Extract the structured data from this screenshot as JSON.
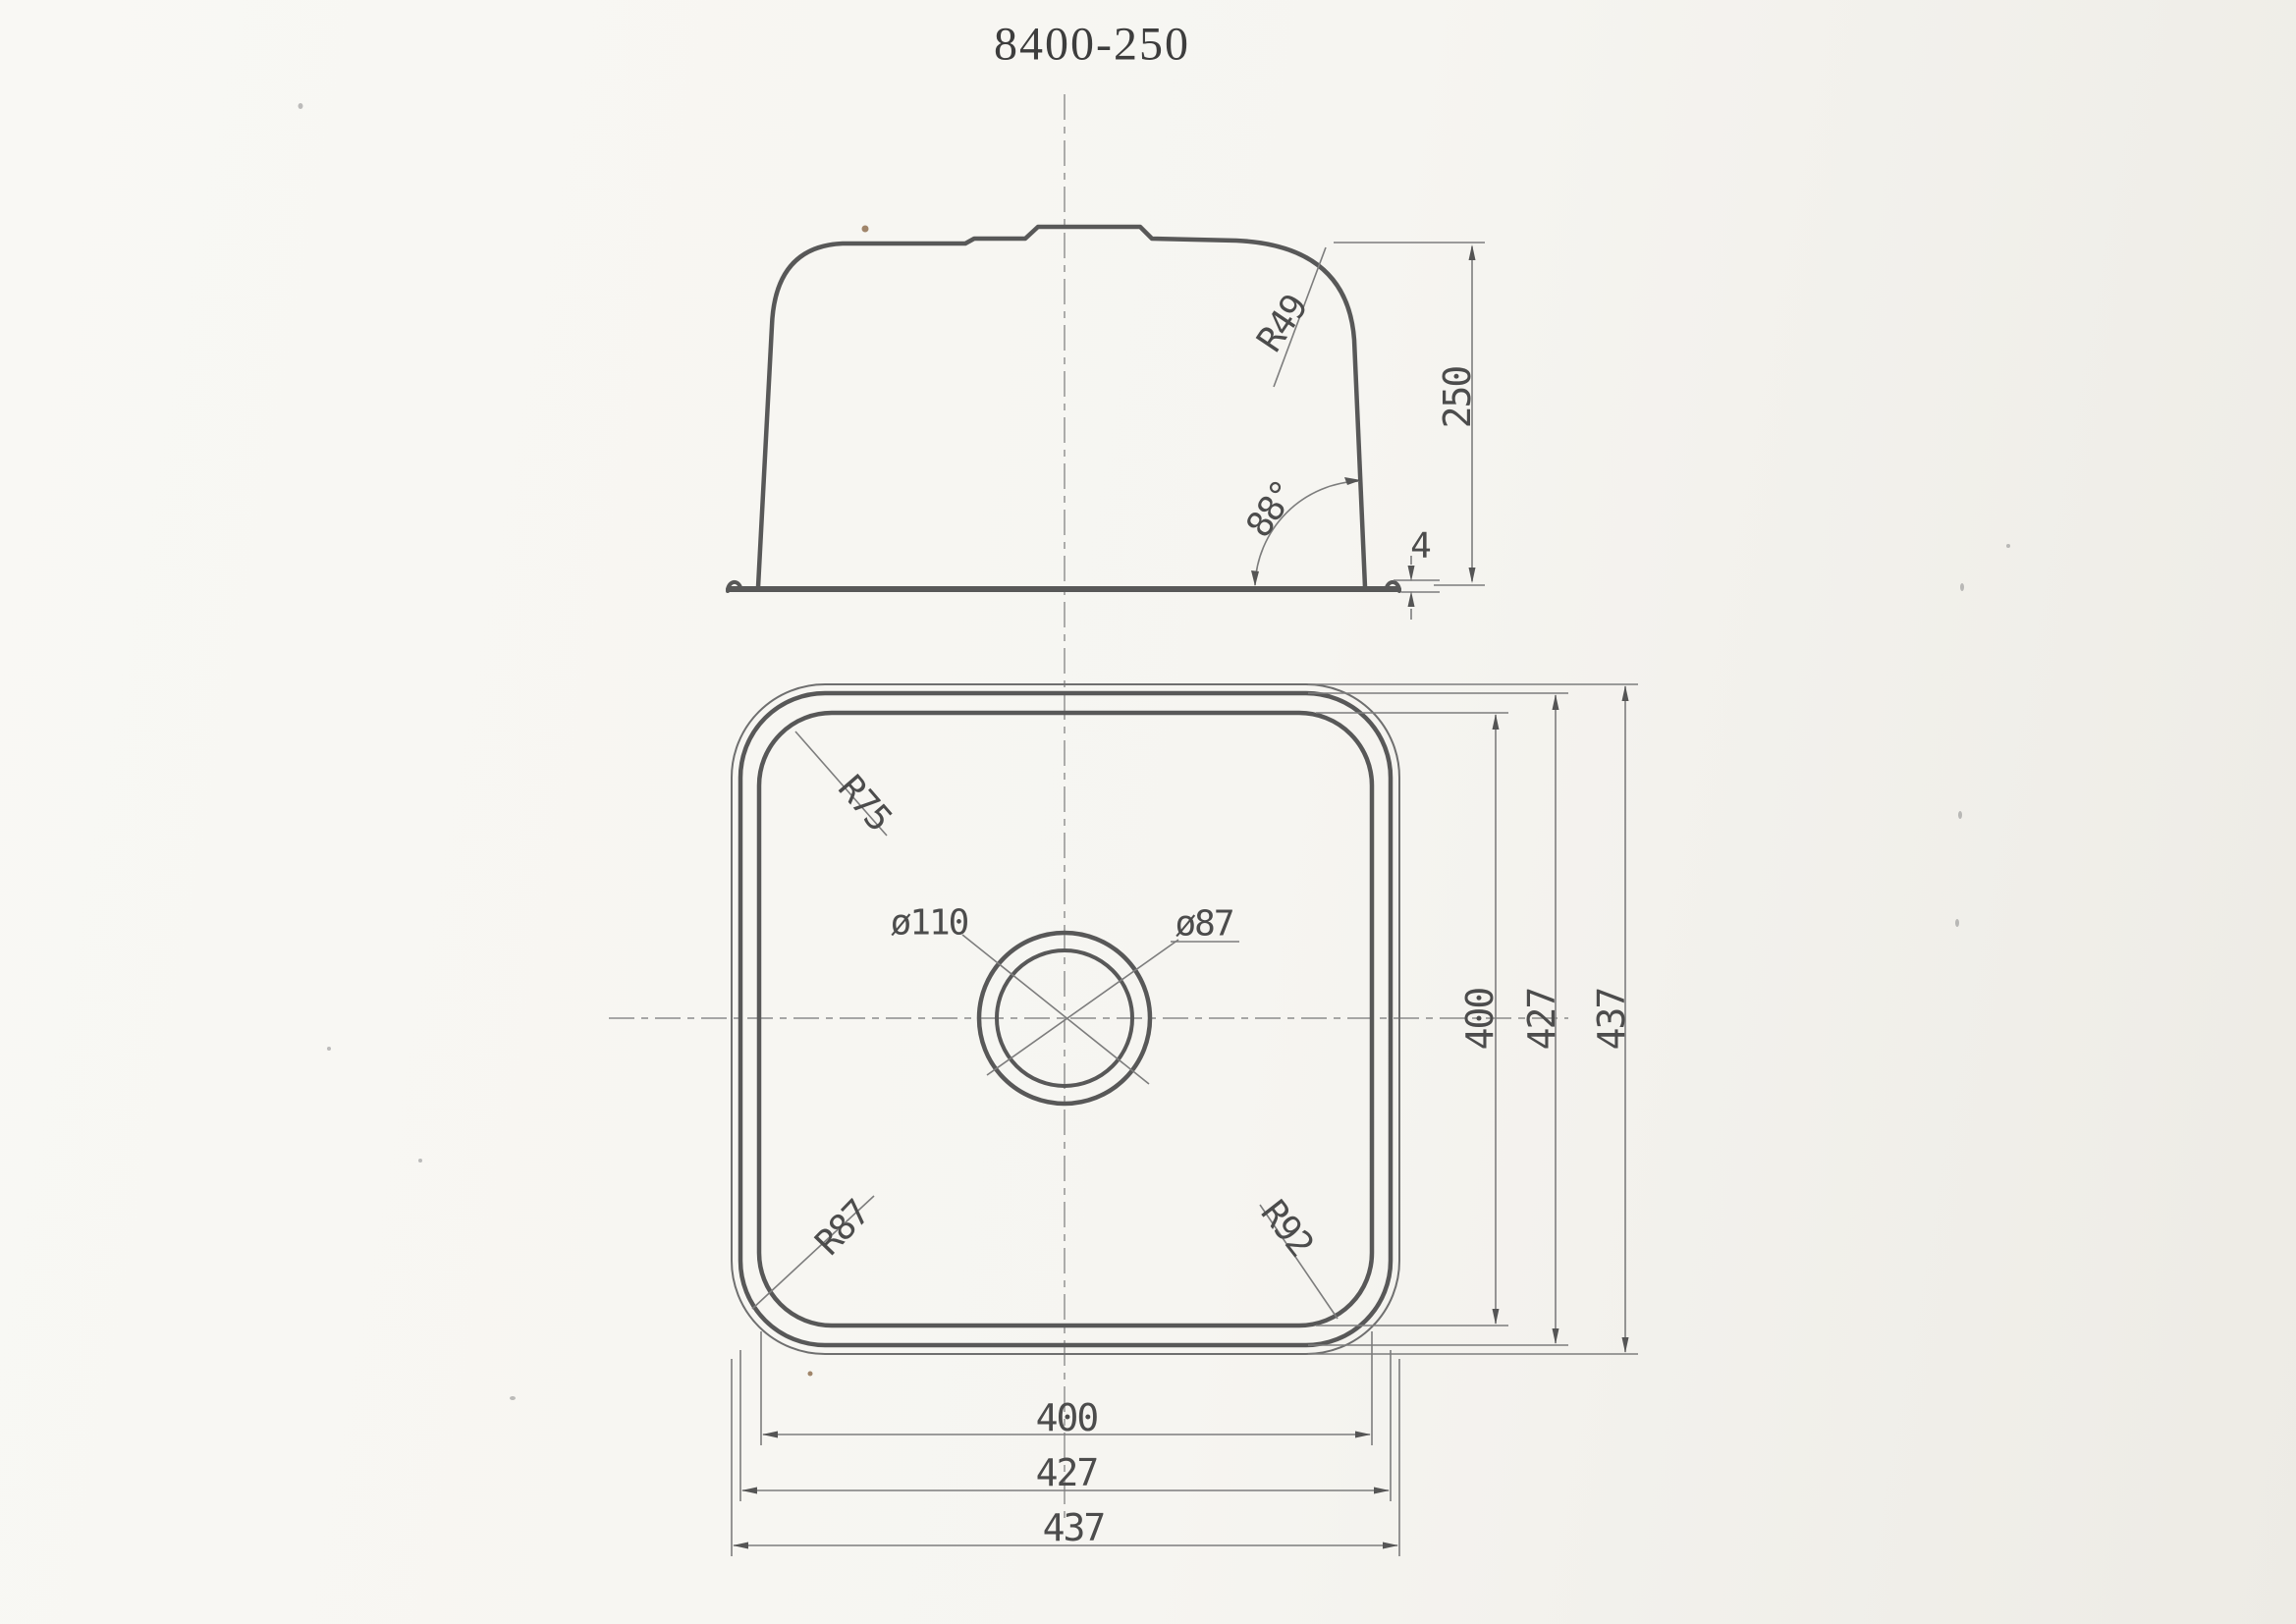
{
  "title": "8400-250",
  "colors": {
    "line_heavy": "#585858",
    "line_thin": "#7d7d7d",
    "text": "#4c4c4c",
    "paper": "#f7f6f2"
  },
  "side_view": {
    "corner_radius": "R49",
    "depth": "250",
    "wall_angle": "88°",
    "rim_thickness": "4"
  },
  "plan_view": {
    "corner_radius_top_left": "R75",
    "corner_radius_bottom_left": "R87",
    "corner_radius_bottom_right": "R92",
    "drain_outer_diameter": "ø110",
    "drain_inner_diameter": "ø87",
    "width_dims": {
      "bowl": "400",
      "rim_inner": "427",
      "rim_outer": "437"
    },
    "depth_dims": {
      "bowl": "400",
      "rim_inner": "427",
      "rim_outer": "437"
    }
  }
}
